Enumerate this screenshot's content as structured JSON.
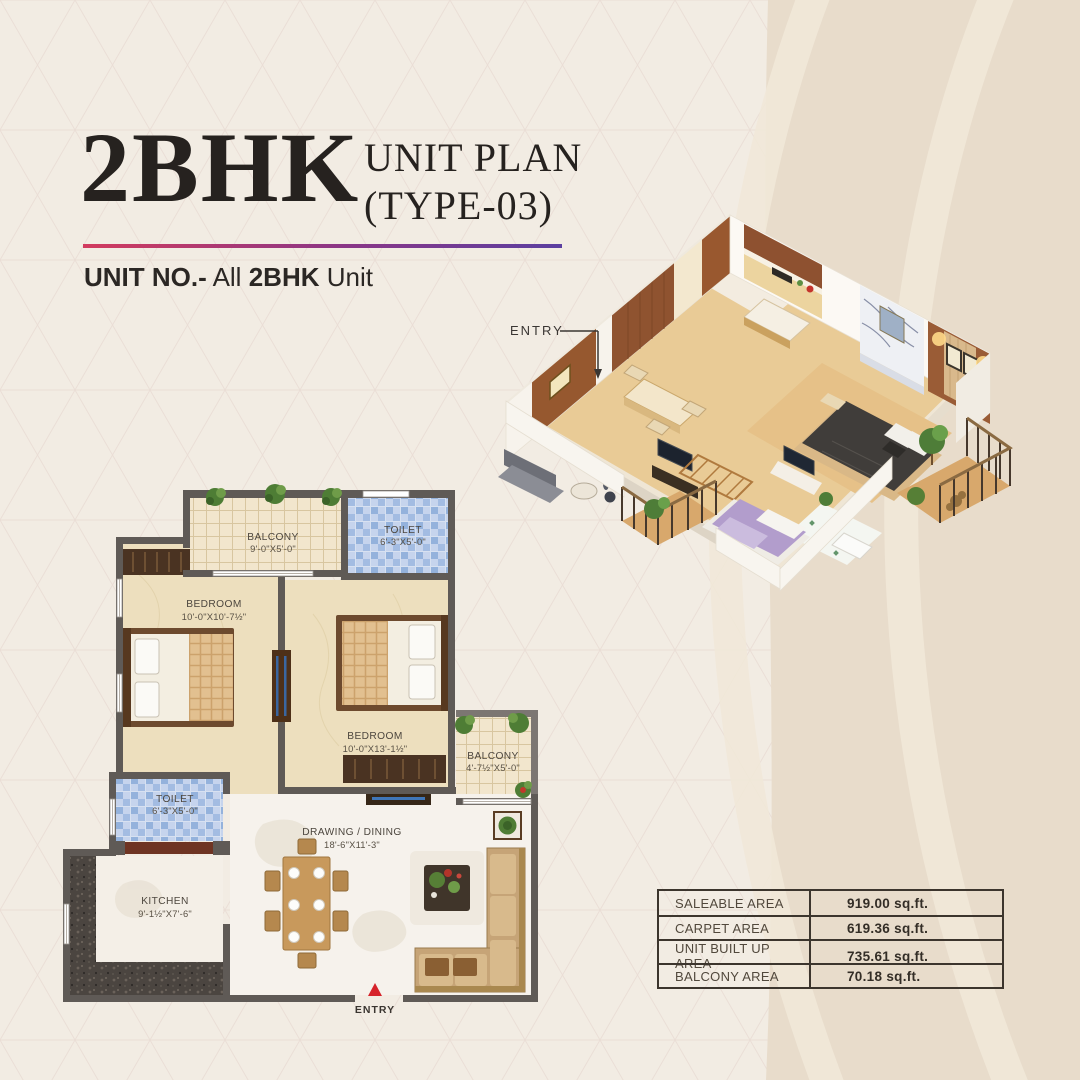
{
  "title": {
    "main": "2BHK",
    "sub1": "UNIT PLAN",
    "sub2": "(TYPE-03)"
  },
  "unit_line": {
    "label": "UNIT NO.-",
    "mid": "All",
    "bold": "2BHK",
    "tail": "Unit"
  },
  "plan3d": {
    "entry_label": "ENTRY"
  },
  "plan2d": {
    "entry_label": "ENTRY",
    "rooms": [
      {
        "name": "BALCONY",
        "size": "9'-0\"X5'-0\""
      },
      {
        "name": "TOILET",
        "size": "6'-3\"X5'-0\""
      },
      {
        "name": "BEDROOM",
        "size": "10'-0\"X10'-7½\""
      },
      {
        "name": "BEDROOM",
        "size": "10'-0\"X13'-1½\""
      },
      {
        "name": "BALCONY",
        "size": "4'-7½\"X5'-0\""
      },
      {
        "name": "TOILET",
        "size": "6'-3\"X5'-0\""
      },
      {
        "name": "DRAWING / DINING",
        "size": "18'-6\"X11'-3\""
      },
      {
        "name": "KITCHEN",
        "size": "9'-1½\"X7'-6\""
      }
    ]
  },
  "area_table": {
    "rows": [
      {
        "label": "SALEABLE AREA",
        "value": "919.00 sq.ft."
      },
      {
        "label": "CARPET AREA",
        "value": "619.36 sq.ft."
      },
      {
        "label": "UNIT BUILT UP AREA",
        "value": "735.61 sq.ft."
      },
      {
        "label": "BALCONY AREA",
        "value": "70.18 sq.ft."
      }
    ]
  },
  "colors": {
    "background": "#f2ece3",
    "right_band": "#e8dccb",
    "accent_from": "#d23b5e",
    "accent_to": "#5b3fa0",
    "title_text": "#26221f",
    "wall_gray": "#5f5a56",
    "entry_red": "#d6232a",
    "table_border": "#3c352d"
  }
}
